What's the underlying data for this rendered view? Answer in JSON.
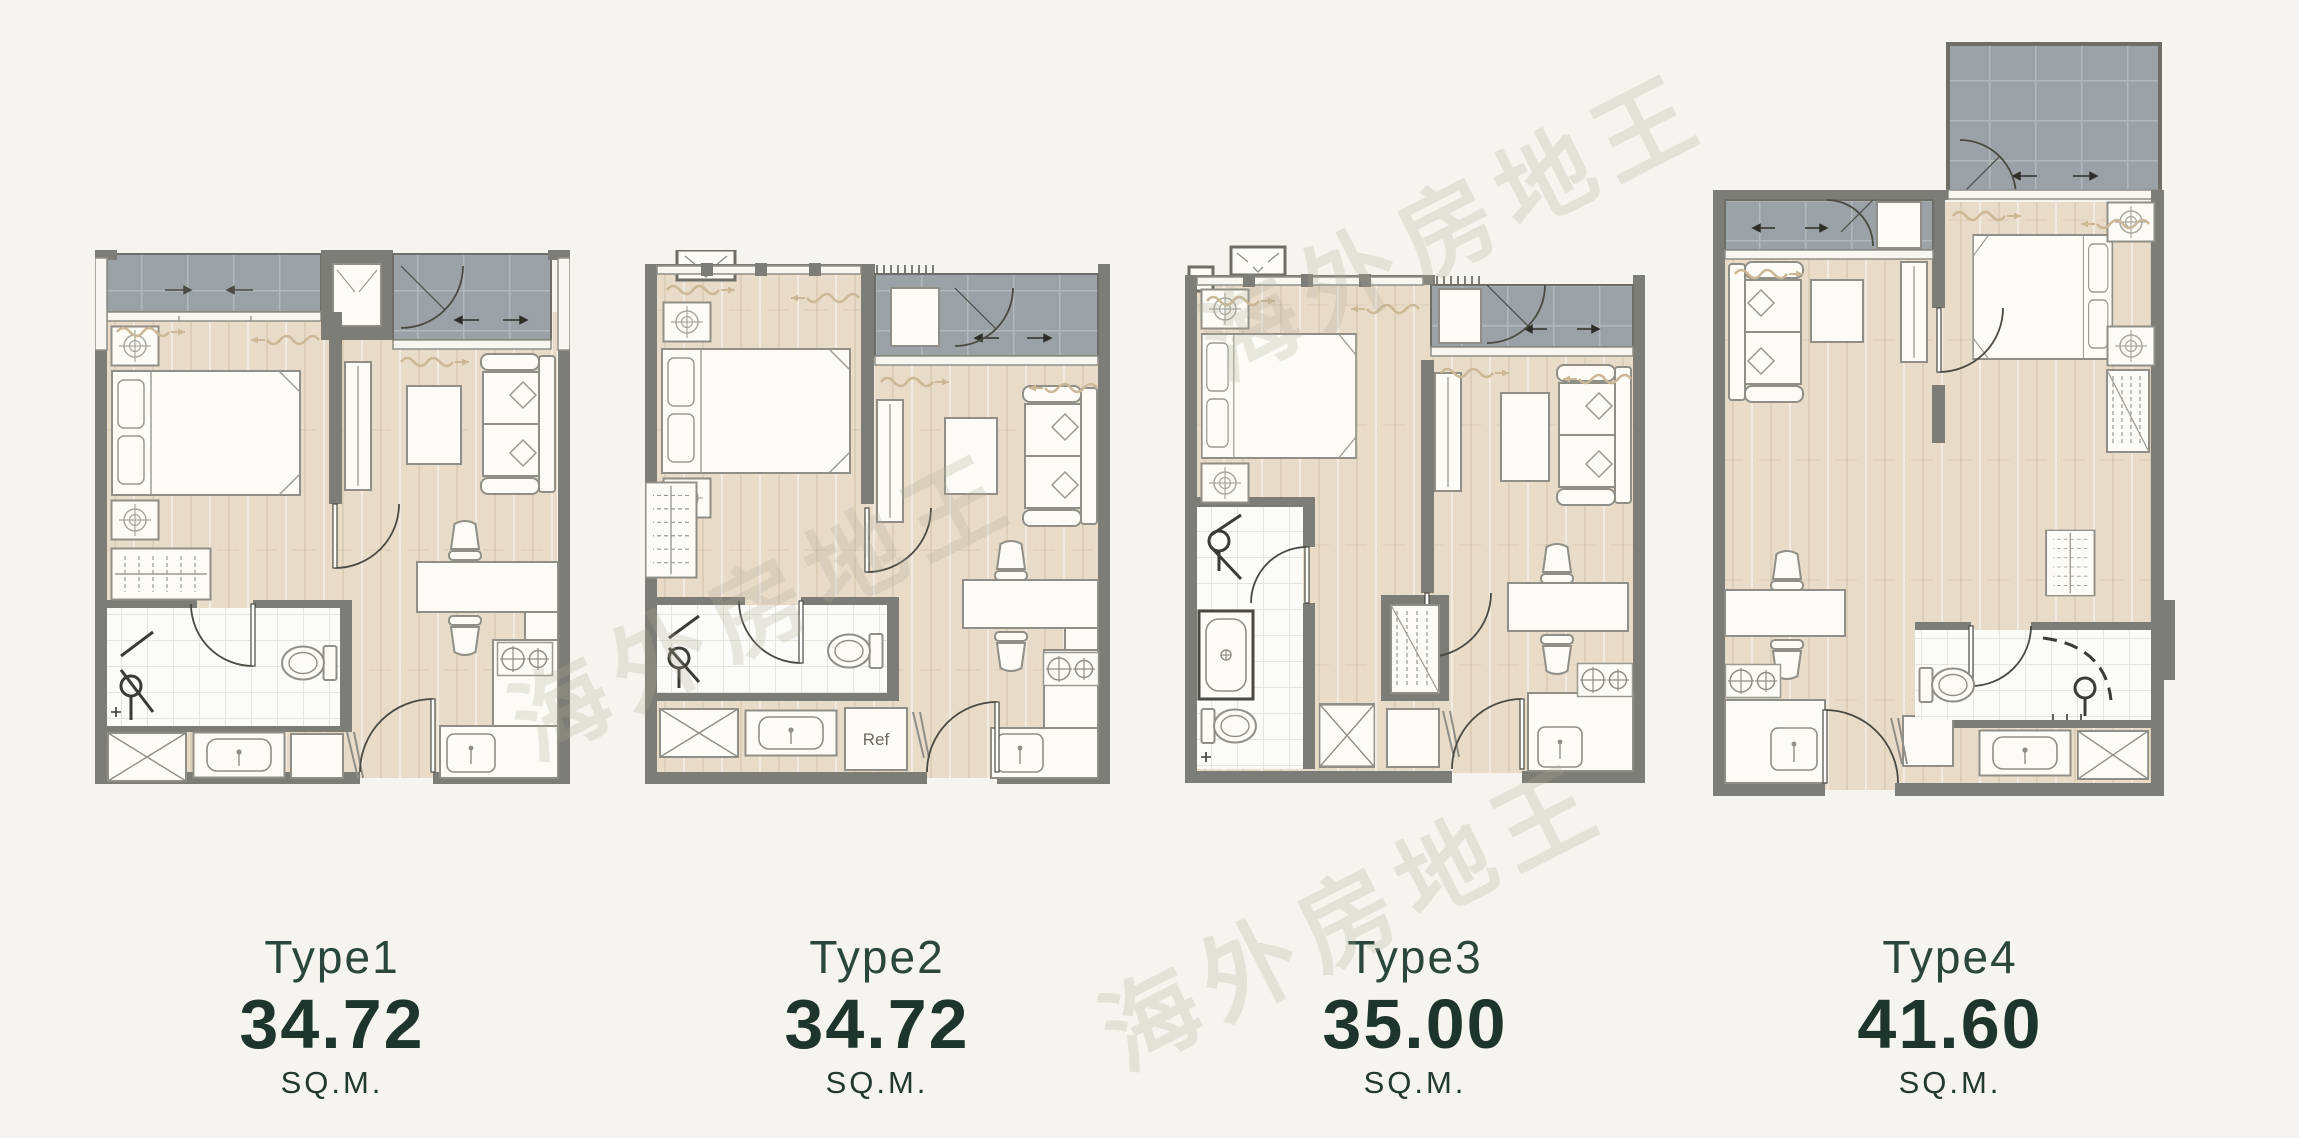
{
  "page": {
    "background_color": "#f5f4ee"
  },
  "watermark": {
    "text": "海外房地王",
    "color": "rgba(172,170,152,0.25)"
  },
  "plans": [
    {
      "id": "type1",
      "label": "Type1",
      "area": "34.72",
      "unit": "SQ.M."
    },
    {
      "id": "type2",
      "label": "Type2",
      "area": "34.72",
      "unit": "SQ.M."
    },
    {
      "id": "type3",
      "label": "Type3",
      "area": "35.00",
      "unit": "SQ.M."
    },
    {
      "id": "type4",
      "label": "Type4",
      "area": "41.60",
      "unit": "SQ.M."
    }
  ],
  "annotations": {
    "fridge_label": "Ref"
  },
  "colors": {
    "wall": "#7d7d77",
    "floor_wood": "#e8dbc8",
    "balcony_tile": "#9aa2a7",
    "bathroom_tile": "#fbfbf7",
    "furniture_fill": "#fcfbf6",
    "label_text": "#22392f",
    "area_text": "#1d352c"
  }
}
